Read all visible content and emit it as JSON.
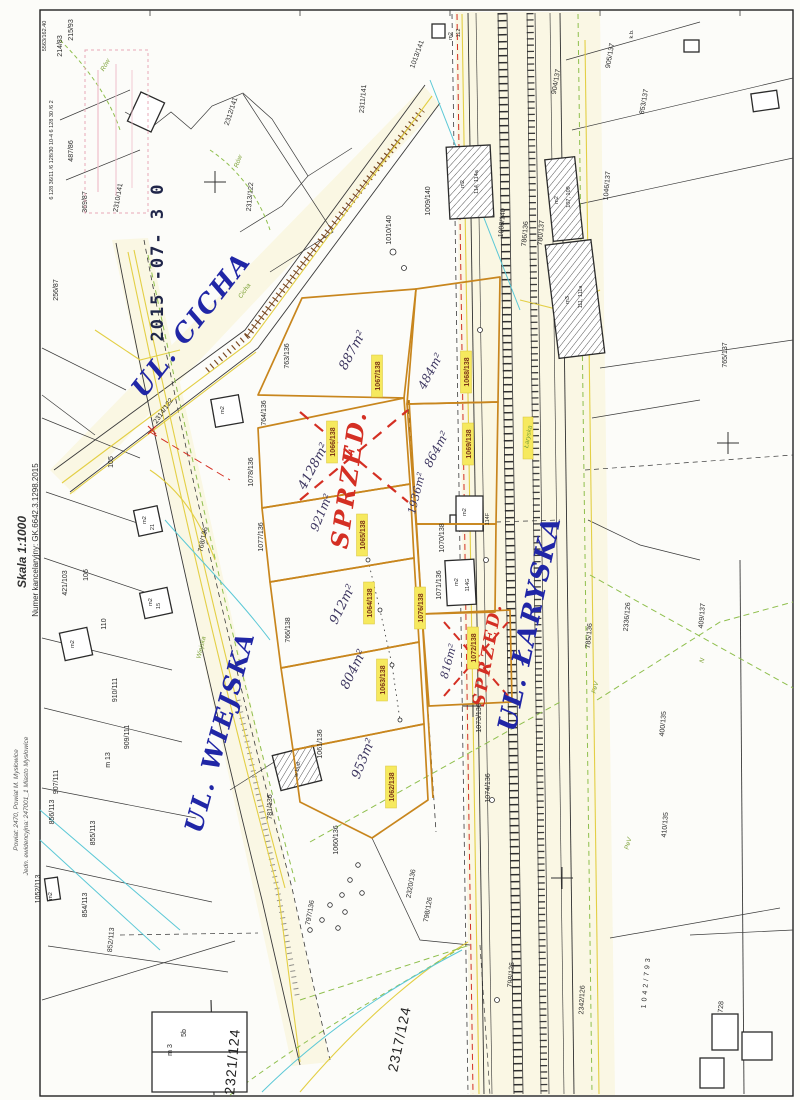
{
  "meta": {
    "scan_code": "5563/162.40",
    "grid_numbers": "6 128 36/11  /6 128/30 10-4  6 128 30 /6 2"
  },
  "margin": {
    "scale": "Skala 1:1000",
    "case_number": "Numer kancelaryjny: GK.6642.3.1298.2015",
    "county": "Powiat: 2470, Powiat M. Mysłowice",
    "unit": "Jedn. ewidencyjna: 247001_1 Miasto Mysłowice"
  },
  "stamp": {
    "date": "2015 -07- 3 0"
  },
  "streets": {
    "cicha": "UL. CICHA",
    "wiejska": "UL. WIEJSKA",
    "laryska": "UL. ŁARYSKA"
  },
  "road_names_small": {
    "cicha": "Cicha",
    "wiejska": "Wiejska",
    "laryska": "Łaryska",
    "row": "Rów",
    "fev": "FeV",
    "pev": "PeV",
    "n": "N"
  },
  "annotations": {
    "sprzed1": "SPRZED.",
    "sprzed2": "SPRZED."
  },
  "offered_parcels": [
    {
      "id": "1067/138",
      "area": "887m²"
    },
    {
      "id": "1068/138",
      "area": "484m²"
    },
    {
      "id": "1069/138",
      "area": "864m²"
    },
    {
      "id": "1066/138",
      "area": "4128m²"
    },
    {
      "id": "1065/138",
      "area": "921m²"
    },
    {
      "id": "1064/138",
      "area": "912m²"
    },
    {
      "id": "1063/138",
      "area": "804m²"
    },
    {
      "id": "1062/138",
      "area": "953m²"
    },
    {
      "id": "1072/138",
      "area": "816m²"
    },
    {
      "id": "1076/138",
      "area": "1936m²"
    }
  ],
  "parcels": {
    "p215_93": "215/93",
    "p214_83": "214/83",
    "p487_86": "487/86",
    "p369_87": "369/87",
    "p256_87": "256/87",
    "p2310_141": "2310/141",
    "p2312_141": "2312/141",
    "p2313_122": "2313/122",
    "p2311_141": "2311/141",
    "p1013_141": "1013/141",
    "p1010_140": "1010/140",
    "p1009_140": "1009/140",
    "p1008_140": "1008/140",
    "p780_137": "780/137",
    "p786_136": "786/136",
    "p763_136": "763/136",
    "p764_136": "764/136",
    "p1078_136": "1078/136",
    "p1077_136": "1077/136",
    "p768_136": "768/136",
    "p766_138": "766/138",
    "p910_111": "910/111",
    "p909_111": "909/111",
    "p907_111": "907/111",
    "p856_113": "856/113",
    "p855_113": "855/113",
    "p854_113": "854/113",
    "p1052_113": "1052/113",
    "p852_113": "852/113",
    "p421_103": "421/103",
    "p106": "106",
    "p105": "105",
    "p110": "110",
    "p2314_122": "2314/122",
    "p1070_138": "1070/138",
    "p1071_136": "1071/136",
    "p1073_136": "1073/136",
    "p1074_136": "1074/136",
    "p1061_136": "1061/136",
    "p781_136": "781/136",
    "p1060_136": "1060/136",
    "p797_136": "797/136",
    "p2320_136": "2320/136",
    "p798_126": "798/126",
    "p798_126b": "798/126",
    "p2336_126": "2336/126",
    "p409_137": "409/137",
    "p400_135": "400/135",
    "p410_135": "410/135",
    "p785_136": "785/136",
    "p765_137": "765/137",
    "p904_137": "904/137",
    "p905_137": "905/137",
    "p853_137": "853/137",
    "p1046_137": "1046/137",
    "p2317_124": "2317/124",
    "p2321_124": "2321/124",
    "p1042_793": "1042/793",
    "p728": "728",
    "p2342_126": "2342/126"
  },
  "buildings": {
    "m2": "m2",
    "m3": "m3",
    "b114": "114, 114a",
    "b107": "107, 109",
    "b111": "111, 111a",
    "b114F": "114F",
    "b114G": "114G",
    "b112": "112",
    "b21": "21",
    "b15": "15",
    "b13": "m 13",
    "wbud": "w bud.",
    "bm3": "m 3",
    "b5b": "5b",
    "kb": "k.b."
  },
  "colors": {
    "highlight": "#f6e95e",
    "street_ink": "#2026a6",
    "sale_red": "#d42f23",
    "parcel_orange": "#c8861e",
    "railway_black": "#2f2f2f"
  }
}
